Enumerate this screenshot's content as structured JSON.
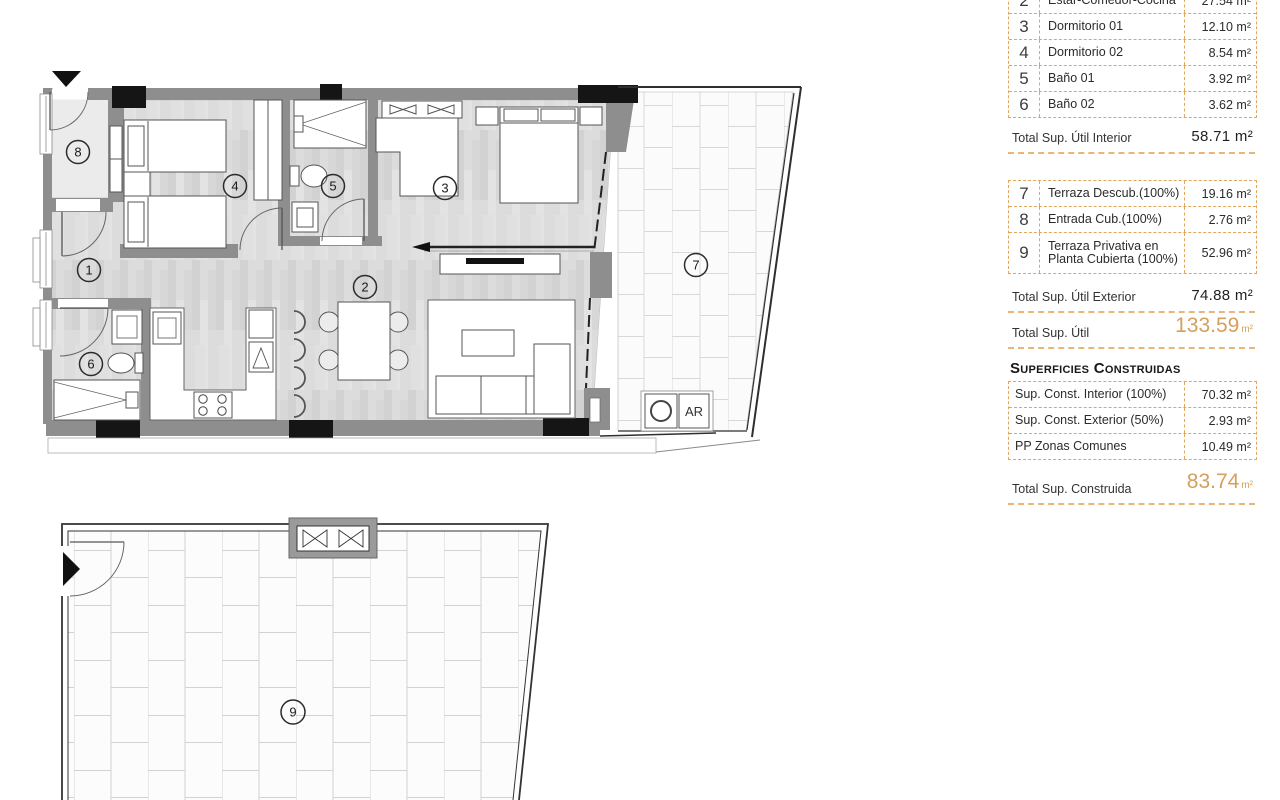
{
  "panel": {
    "interior_table": {
      "rows": [
        {
          "num": "2",
          "label": "Estar-Comedor-Cocina",
          "value": "27.54 m²"
        },
        {
          "num": "3",
          "label": "Dormitorio 01",
          "value": "12.10 m²"
        },
        {
          "num": "4",
          "label": "Dormitorio 02",
          "value": "8.54 m²"
        },
        {
          "num": "5",
          "label": "Baño 01",
          "value": "3.92 m²"
        },
        {
          "num": "6",
          "label": "Baño 02",
          "value": "3.62 m²"
        }
      ]
    },
    "total_interior": {
      "label": "Total Sup. Útil Interior",
      "value": "58.71 m²"
    },
    "exterior_table": {
      "rows": [
        {
          "num": "7",
          "label": "Terraza Descub.(100%)",
          "value": "19.16 m²"
        },
        {
          "num": "8",
          "label": "Entrada Cub.(100%)",
          "value": "2.76 m²"
        },
        {
          "num": "9",
          "label": "Terraza Privativa en",
          "label2": "Planta Cubierta (100%)",
          "value": "52.96 m²"
        }
      ]
    },
    "total_exterior": {
      "label": "Total Sup. Útil Exterior",
      "value": "74.88 m²"
    },
    "total_util": {
      "label": "Total Sup. Útil",
      "value": "133.59",
      "unit": "m²"
    },
    "constructed_header": "Superficies Construidas",
    "constructed_table": {
      "rows": [
        {
          "label": "Sup. Const. Interior (100%)",
          "value": "70.32 m²"
        },
        {
          "label": "Sup. Const. Exterior (50%)",
          "value": "2.93 m²"
        },
        {
          "label": "PP Zonas Comunes",
          "value": "10.49 m²"
        }
      ]
    },
    "total_constructed": {
      "label": "Total Sup. Construida",
      "value": "83.74",
      "unit": "m²"
    }
  },
  "plan": {
    "rooms": {
      "r1": "1",
      "r2": "2",
      "r3": "3",
      "r4": "4",
      "r5": "5",
      "r6": "6",
      "r7": "7",
      "r8": "8",
      "r9": "9"
    },
    "ar_label": "AR",
    "site_letters": {
      "left": "P",
      "top": "R",
      "right": "S"
    }
  },
  "colors": {
    "accent_dashed": "#e3a45c",
    "total_orange": "#d4a05c",
    "highlight_orange": "#f0af6e",
    "highlight_blue": "#4f9cba",
    "wall_gray": "#8e8e8e"
  }
}
